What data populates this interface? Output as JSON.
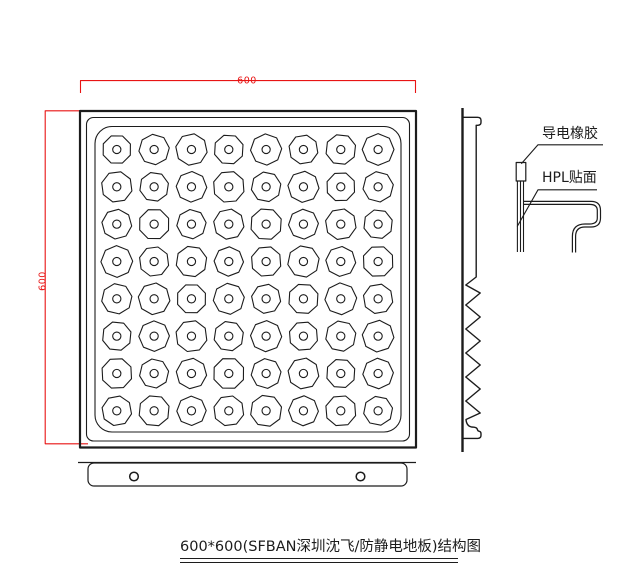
{
  "drawing": {
    "caption": "600*600(SFBAN深圳沈飞/防静电地板)结构图",
    "dimensions": {
      "width_label": "600",
      "height_label": "600"
    },
    "callouts": {
      "conductive_rubber": "导电橡胶",
      "hpl_face": "HPL贴面"
    },
    "top_view": {
      "dimple_grid": {
        "rows": 8,
        "cols": 8
      },
      "mount_hole_count": 2
    },
    "colors": {
      "line": "#1c1c1c",
      "dimension": "#e81414",
      "background": "#ffffff"
    }
  }
}
